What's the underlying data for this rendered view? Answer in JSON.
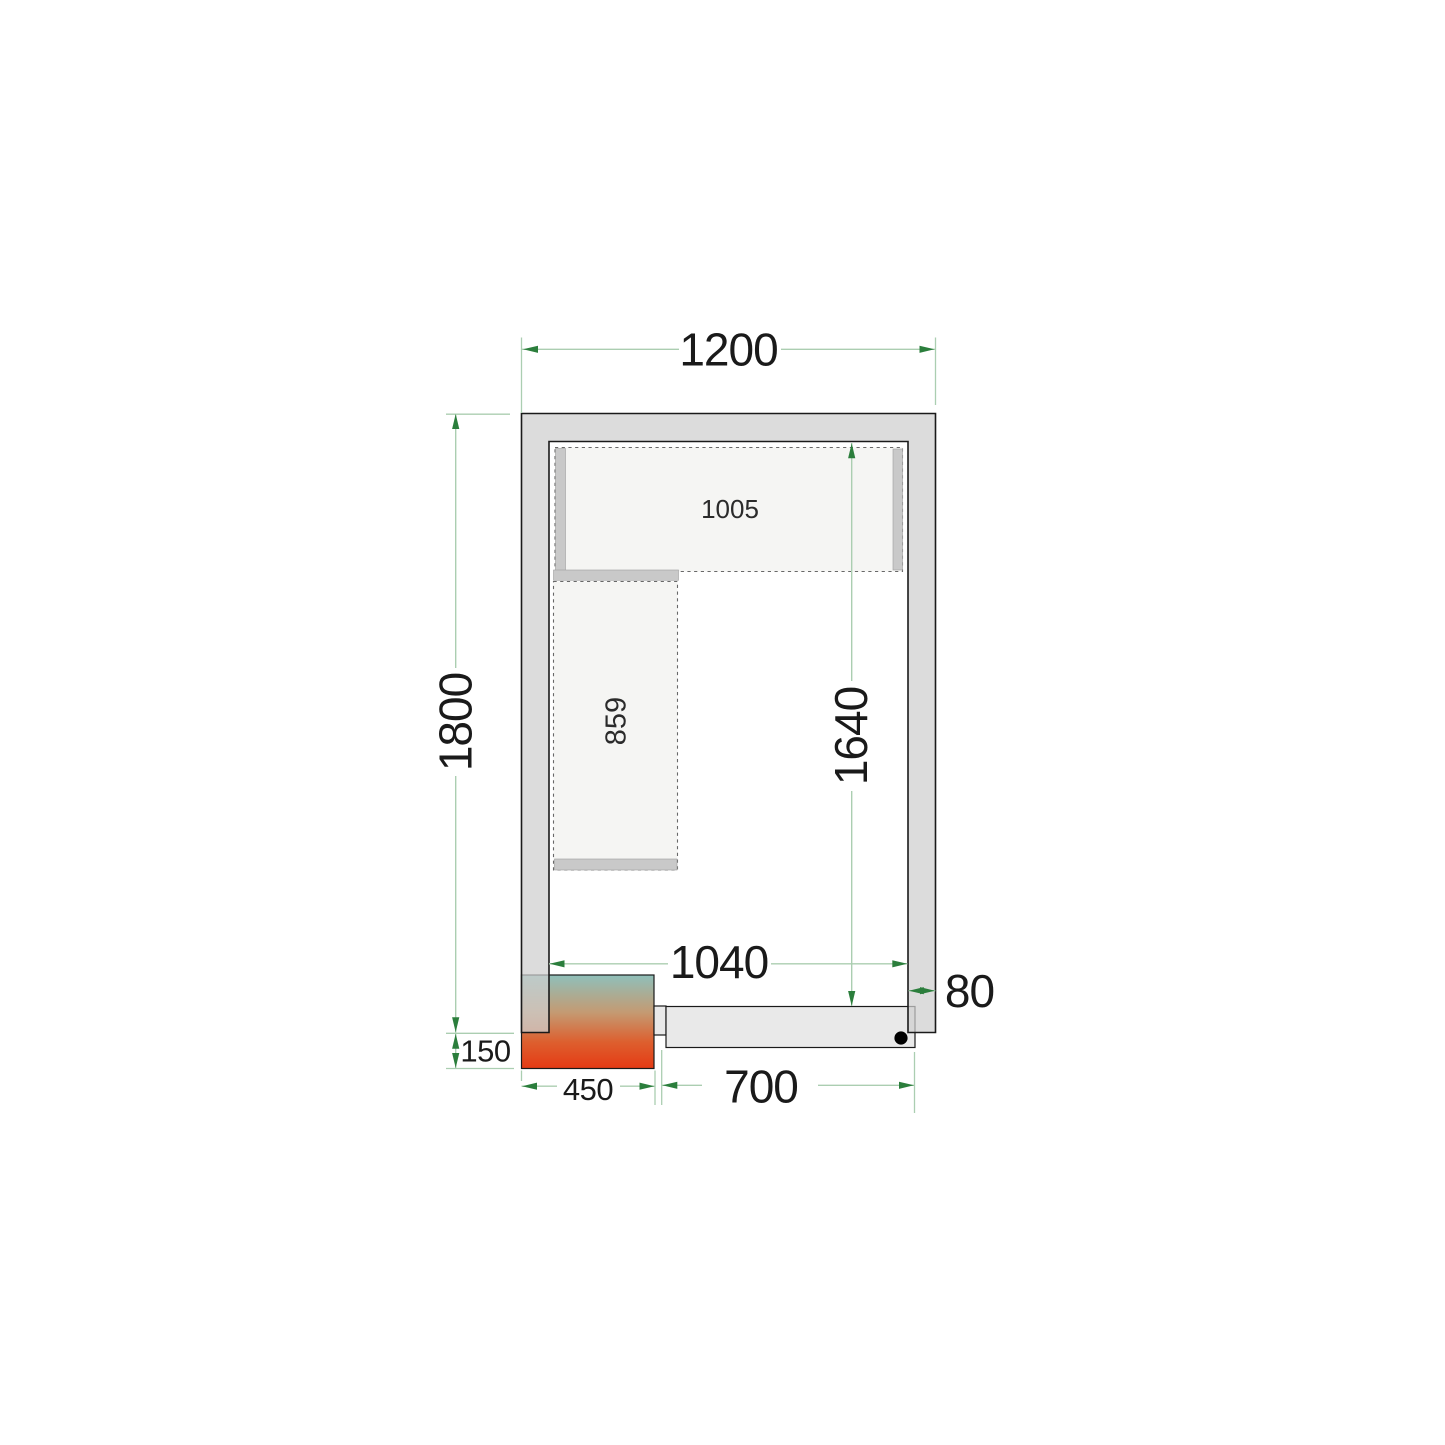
{
  "diagram": {
    "type": "cold-room-floor-plan",
    "dimensions": {
      "outer_width_mm": "1200",
      "outer_depth_mm": "1800",
      "inner_width_mm": "1040",
      "inner_depth_mm": "1640",
      "wall_thickness_mm": "80",
      "top_shelf_length_mm": "1005",
      "left_shelf_length_mm": "859",
      "cooling_unit_width_mm": "450",
      "cooling_unit_protrusion_mm": "150",
      "door_opening_mm": "700"
    },
    "colors": {
      "wall_fill": "#d9d9d9",
      "outline": "#1a1a1a",
      "shelf_fill": "#f5f5f3",
      "shelf_bar": "#c9c9c9",
      "shelf_dash": "#686868",
      "door_fill": "#e9e9e9",
      "dimension_line": "#abceb1",
      "dimension_arrow": "#2b7e3c",
      "text": "#1a1a1a",
      "unit_gradient_top": "#8fc0ba",
      "unit_gradient_mid": "#c49a72",
      "unit_gradient_low": "#dd5f2e",
      "unit_gradient_bottom": "#e53a14"
    }
  }
}
